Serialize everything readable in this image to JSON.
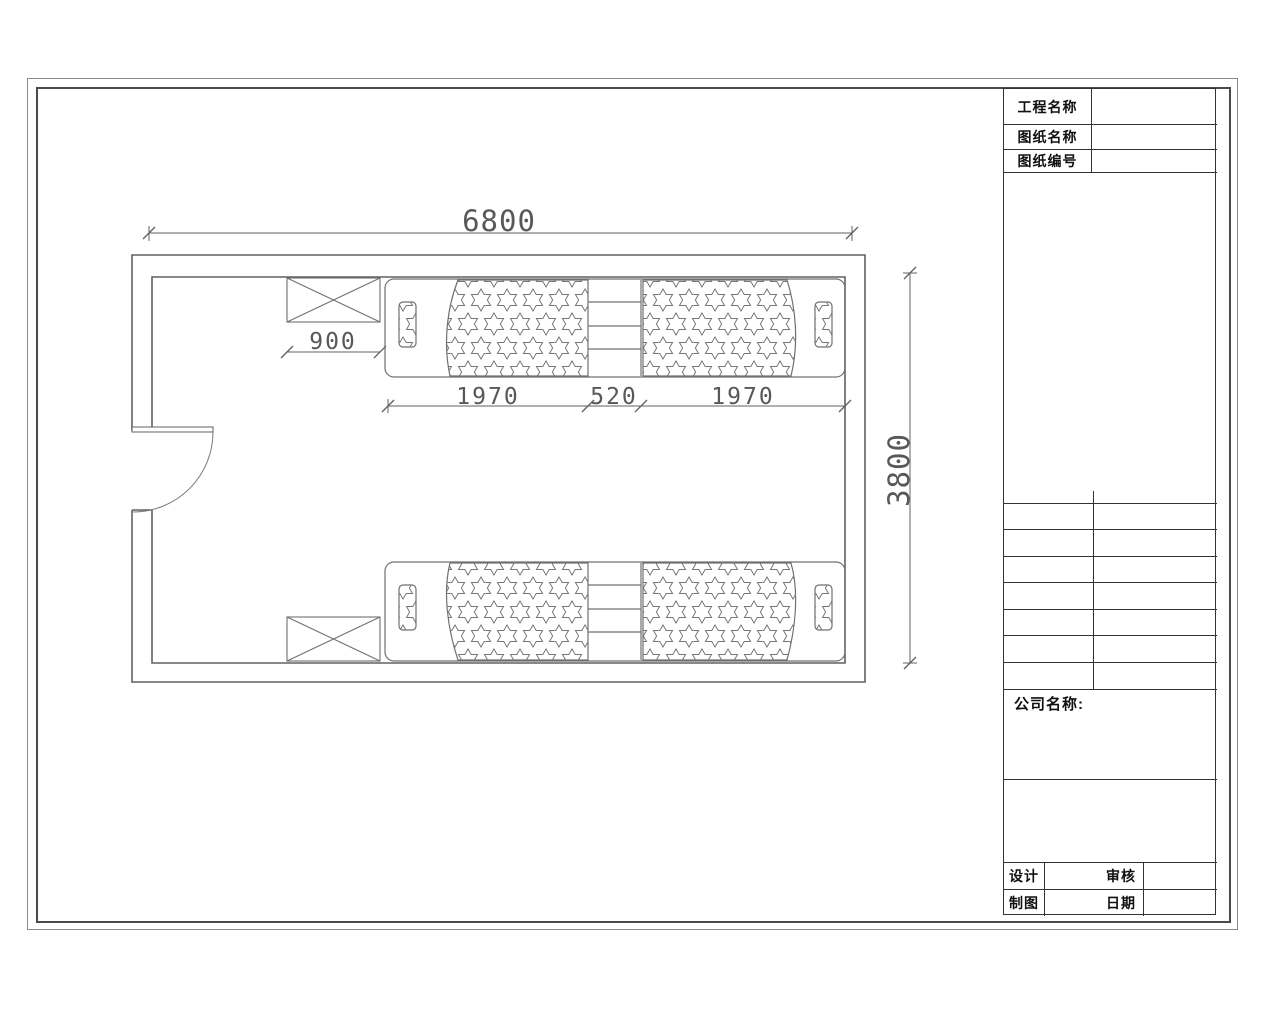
{
  "title_block": {
    "project_label": "工程名称",
    "drawing_name_label": "图纸名称",
    "drawing_no_label": "图纸编号",
    "company_label": "公司名称:",
    "design_label": "设计",
    "check_label": "审核",
    "draft_label": "制图",
    "date_label": "日期"
  },
  "floor_plan": {
    "dim_room_width": "6800",
    "dim_cabinet": "900",
    "dim_bed_left": "1970",
    "dim_ladder": "520",
    "dim_bed_right": "1970",
    "dim_room_depth": "3800"
  }
}
